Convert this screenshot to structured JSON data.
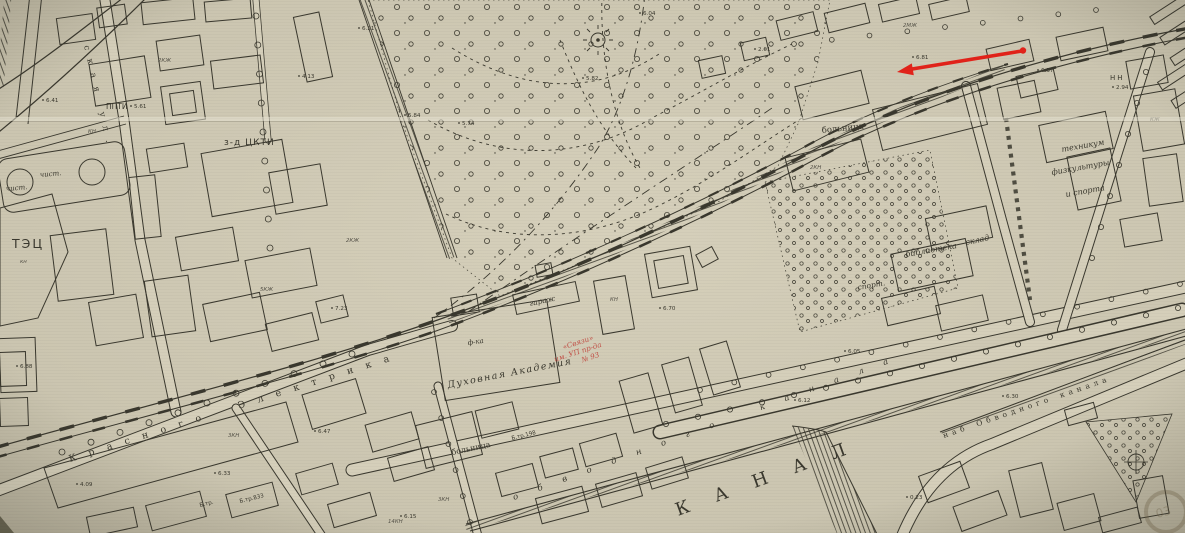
{
  "colors": {
    "paper": "#c9c3ae",
    "paper_light": "#d5cfba",
    "ink": "#3a382e",
    "ink_light": "#57544a",
    "red": "#e2231a",
    "red_soft": "#c04038",
    "fold": "#e6e1d2"
  },
  "labels": {
    "tec": {
      "text": "ТЭЦ"
    },
    "chist_a": {
      "text": "чист."
    },
    "chist_b": {
      "text": "чист."
    },
    "ppti": {
      "text": "ППТИ"
    },
    "zavod_ckti": {
      "text": "з-д ЦКТИ"
    },
    "bolnitsa_ne": {
      "text": "больница"
    },
    "bolnitsa_center": {
      "text": "больница"
    },
    "tekhnikum_1": {
      "text": "техникум"
    },
    "tekhnikum_2": {
      "text": "физкультуры"
    },
    "tekhnikum_3": {
      "text": "и спорта"
    },
    "sklad": {
      "text": "склад"
    },
    "biblioteka": {
      "text": "библиотека"
    },
    "sport": {
      "text": "спорт."
    },
    "garazh": {
      "text": "гараж"
    },
    "f_ka": {
      "text": "ф-ка"
    },
    "akademia": {
      "text": "Духовная Академия"
    },
    "nn": {
      "text": "НН"
    },
    "btr_a": {
      "text": "Б.тр."
    },
    "btr_b": {
      "text": "Б.тр.833"
    },
    "btr_c": {
      "text": "Б.тр.198"
    }
  },
  "street_names": {
    "krasnogo_elektrika": "Красного  Электрика",
    "skaya_ul": "ская  ул.",
    "nab_nw": "обводного  канала",
    "kanal_big": "КАНАЛ",
    "nab_se": "наб  Обводного  канала"
  },
  "red_annotation": {
    "line1": "«Связи»",
    "line2": "им. УП пр-да",
    "line3": "№ 93"
  },
  "stamp": "03",
  "elevations": [
    {
      "t": "6.41",
      "x": 46,
      "y": 102
    },
    {
      "t": "5.61",
      "x": 134,
      "y": 108
    },
    {
      "t": "6.21",
      "x": 362,
      "y": 30
    },
    {
      "t": "4.13",
      "x": 302,
      "y": 78
    },
    {
      "t": "5.84",
      "x": 408,
      "y": 117
    },
    {
      "t": "5.74",
      "x": 462,
      "y": 125
    },
    {
      "t": "7.23",
      "x": 335,
      "y": 310
    },
    {
      "t": "6.88",
      "x": 20,
      "y": 368
    },
    {
      "t": "6.04",
      "x": 643,
      "y": 15
    },
    {
      "t": "5.82",
      "x": 586,
      "y": 80
    },
    {
      "t": "2.01",
      "x": 758,
      "y": 51
    },
    {
      "t": "6.81",
      "x": 916,
      "y": 59
    },
    {
      "t": "6.37",
      "x": 1041,
      "y": 72
    },
    {
      "t": "2.94",
      "x": 1116,
      "y": 89
    },
    {
      "t": "6.70",
      "x": 663,
      "y": 310
    },
    {
      "t": "6.05",
      "x": 848,
      "y": 353
    },
    {
      "t": "6.12",
      "x": 798,
      "y": 402
    },
    {
      "t": "6.30",
      "x": 1006,
      "y": 398
    },
    {
      "t": "6.47",
      "x": 318,
      "y": 433
    },
    {
      "t": "6.33",
      "x": 218,
      "y": 475
    },
    {
      "t": "4.09",
      "x": 80,
      "y": 486
    },
    {
      "t": "6.15",
      "x": 404,
      "y": 518
    },
    {
      "t": "0.23",
      "x": 910,
      "y": 499
    }
  ],
  "build_codes": [
    {
      "t": "кн",
      "x": 20,
      "y": 263
    },
    {
      "t": "КН",
      "x": 88,
      "y": 133
    },
    {
      "t": "2КЖ",
      "x": 158,
      "y": 62
    },
    {
      "t": "5КЖ",
      "x": 260,
      "y": 291
    },
    {
      "t": "2КЖ",
      "x": 346,
      "y": 242
    },
    {
      "t": "2МЖ",
      "x": 903,
      "y": 27
    },
    {
      "t": "2КН",
      "x": 810,
      "y": 169
    },
    {
      "t": "3КН",
      "x": 228,
      "y": 437
    },
    {
      "t": "КН",
      "x": 610,
      "y": 301
    },
    {
      "t": "КЖ",
      "x": 1150,
      "y": 121
    },
    {
      "t": "14КН",
      "x": 388,
      "y": 523
    },
    {
      "t": "3КН",
      "x": 438,
      "y": 501
    }
  ]
}
